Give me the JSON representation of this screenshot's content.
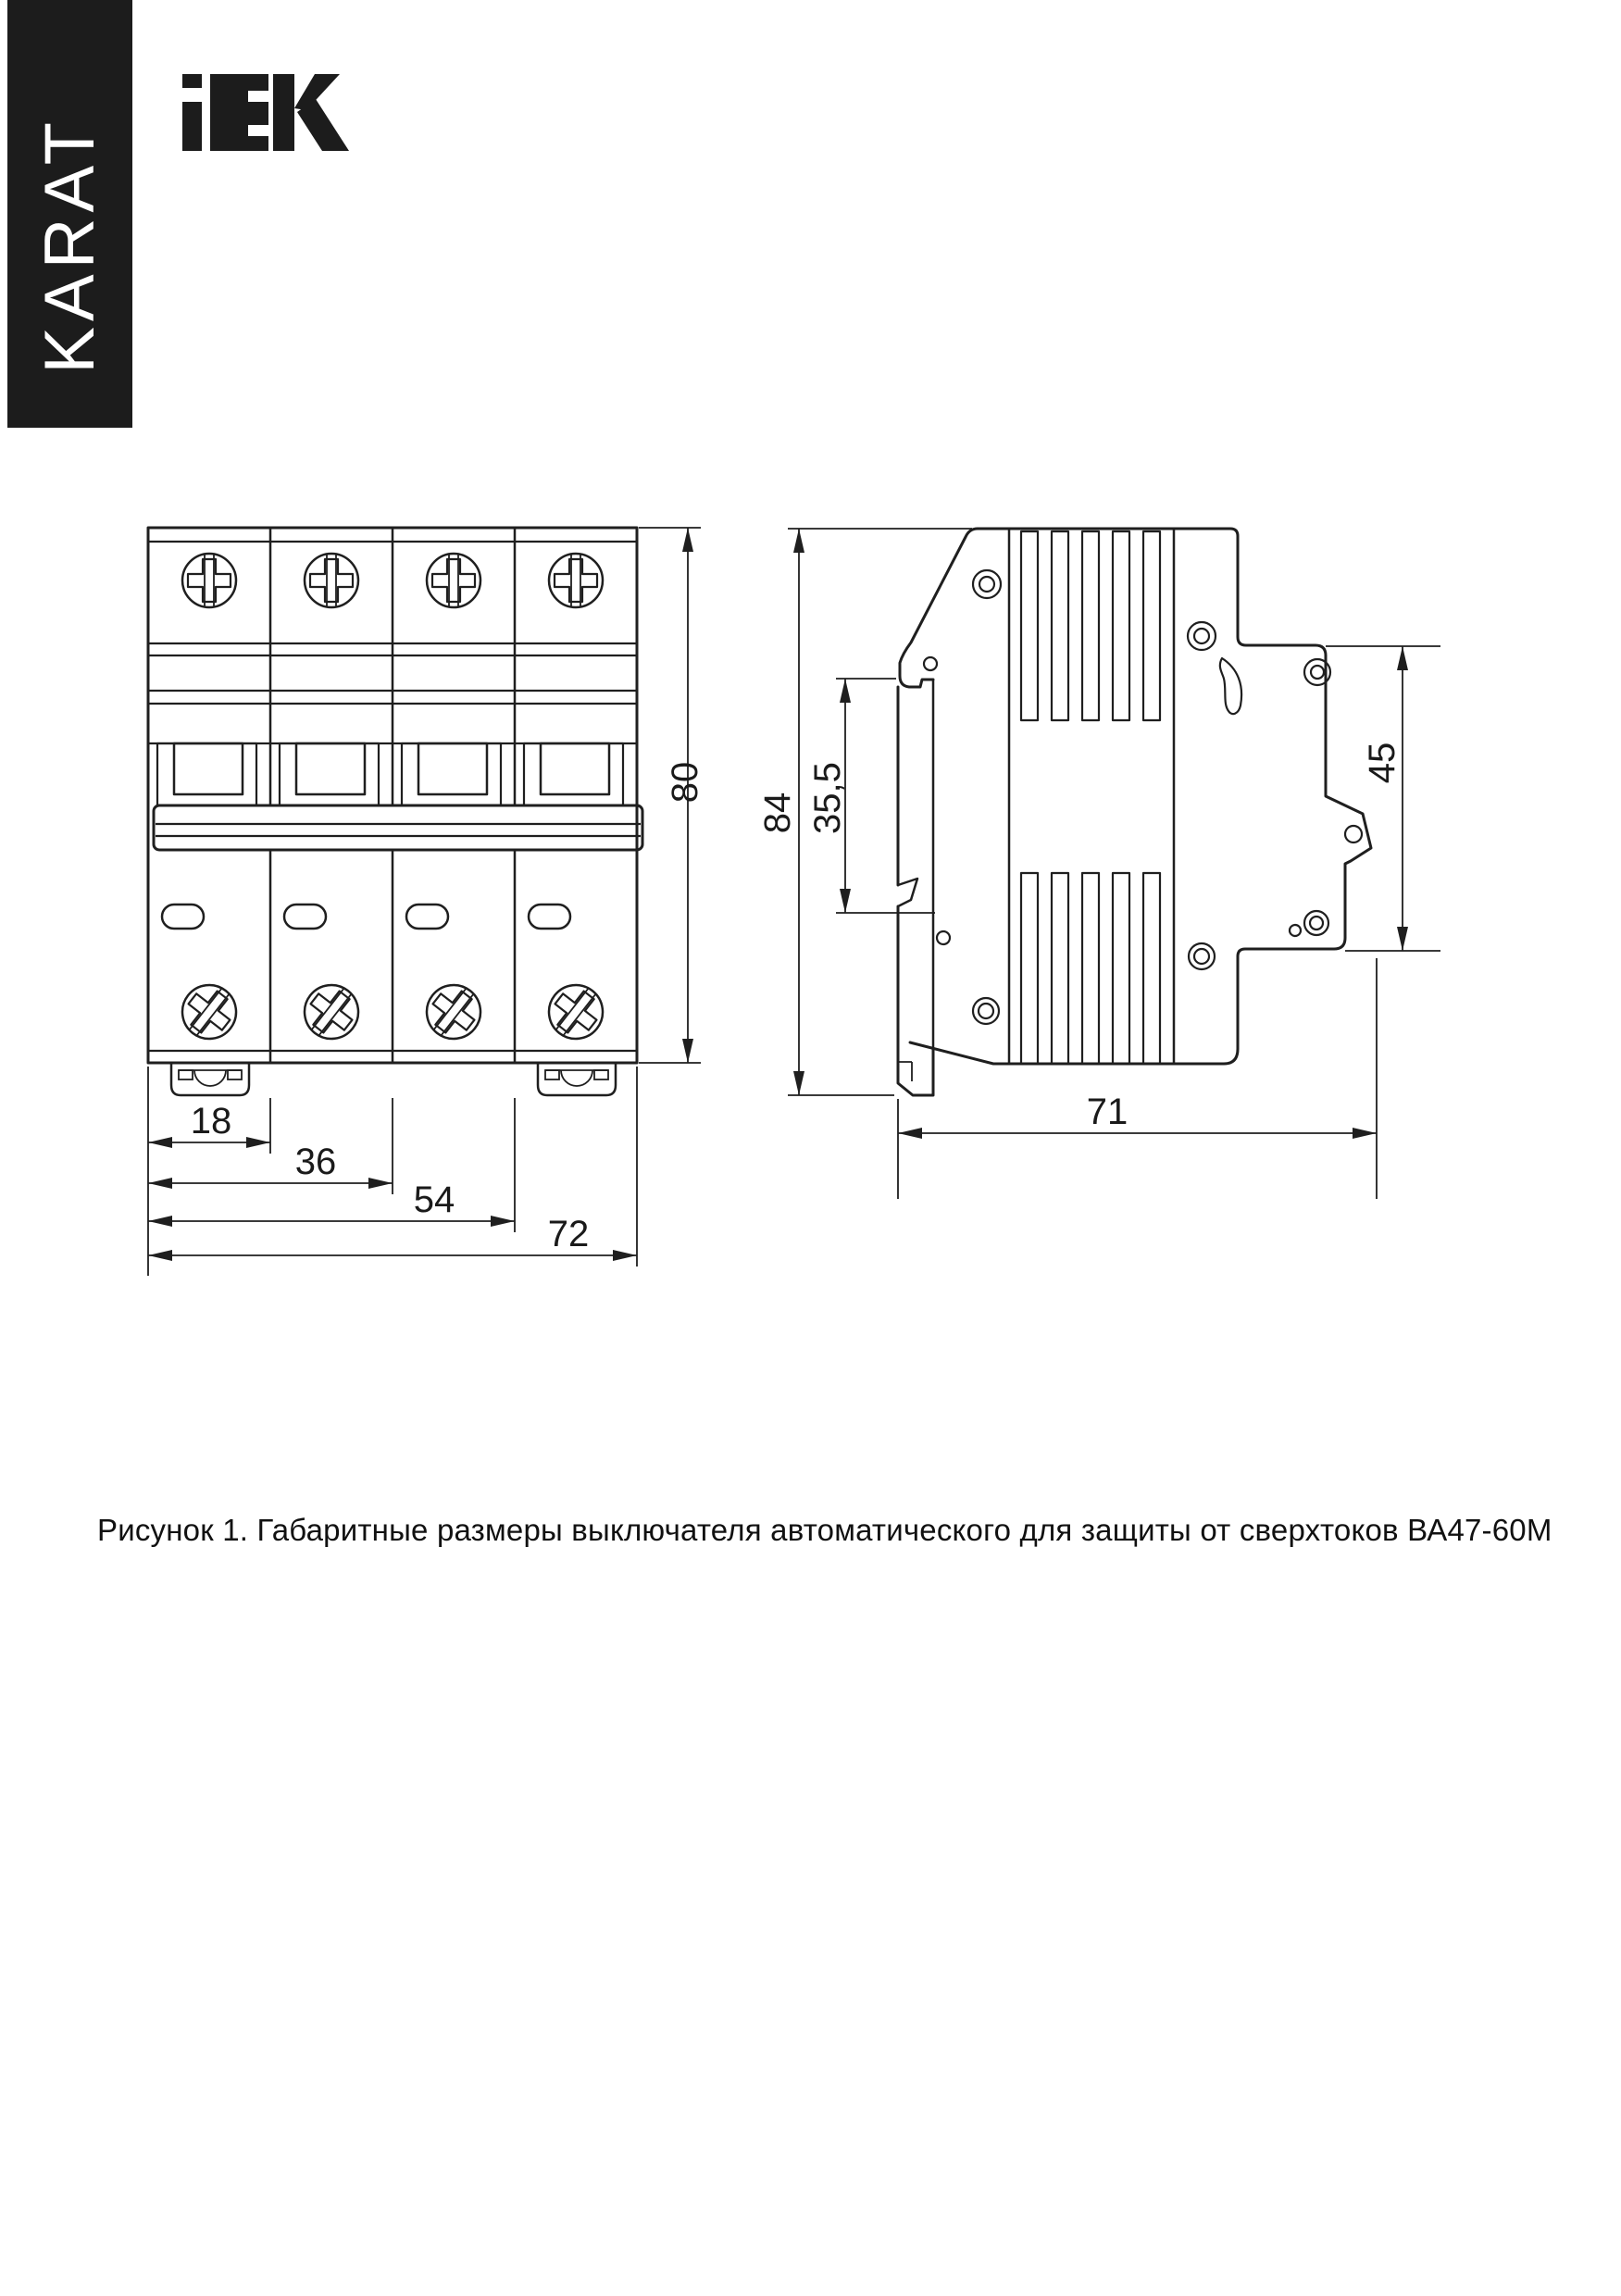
{
  "banner": {
    "text": "KARAT",
    "bg": "#1c1c1c",
    "fg": "#ffffff"
  },
  "brand": {
    "name": "IEK"
  },
  "figure": {
    "caption": "Рисунок 1. Габаритные размеры выключателя автоматического для защиты от сверхтоков ВА47-60М"
  },
  "drawing": {
    "line_color": "#1f1f1f",
    "dims": {
      "pole_width": "18",
      "two_poles": "36",
      "three_poles": "54",
      "total_width": "72",
      "front_height": "80",
      "side_height": "84",
      "handle_offset": "35,5",
      "rail_zone": "45",
      "depth": "71"
    }
  }
}
